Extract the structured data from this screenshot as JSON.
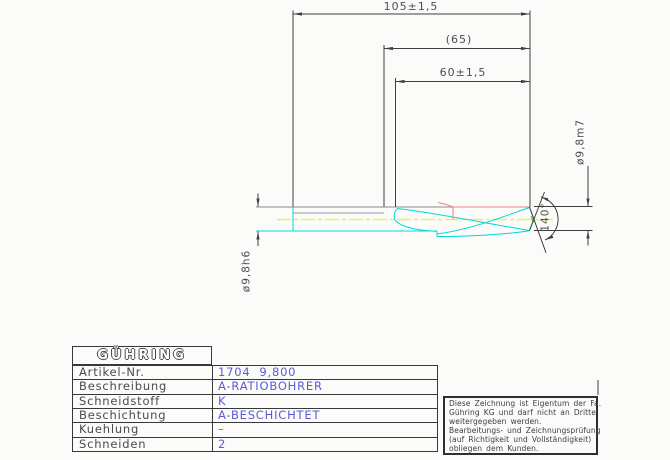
{
  "drawing": {
    "dims": {
      "overall_length": "105±1,5",
      "ref_length": "(65)",
      "flute_length": "60±1,5",
      "tip_diameter": "ø9,8m7",
      "shank_diameter": "ø9,8h6",
      "point_angle": "140°"
    },
    "colors": {
      "dimension_lines": "#3f3f3f",
      "body_gray": "#8a8a8a",
      "flute_cyan": "#00d8d8",
      "centerline_yellow": "#f2ec58",
      "edge_red": "#ee8282",
      "chisel_green": "#3cc43c"
    }
  },
  "titleblock": {
    "logo": "GÜHRING",
    "rows": [
      {
        "label": "Artikel-Nr.",
        "value": "1704  9,800"
      },
      {
        "label": "Beschreibung",
        "value": "A-RATIOBOHRER"
      },
      {
        "label": "Schneidstoff",
        "value": "K"
      },
      {
        "label": "Beschichtung",
        "value": "A-BESCHICHTET"
      },
      {
        "label": "Kuehlung",
        "value": "–"
      },
      {
        "label": "Schneiden",
        "value": "2"
      }
    ],
    "value_color": "#5b5bd8"
  },
  "note": {
    "lines": [
      "Diese Zeichnung ist Eigentum der Fa.",
      "Gühring KG und darf nicht an Dritte",
      "weitergegeben werden.",
      "Bearbeitungs- und Zeichnungsprüfung",
      "(auf Richtigkeit und Vollständigkeit)",
      "obliegen dem Kunden."
    ]
  }
}
